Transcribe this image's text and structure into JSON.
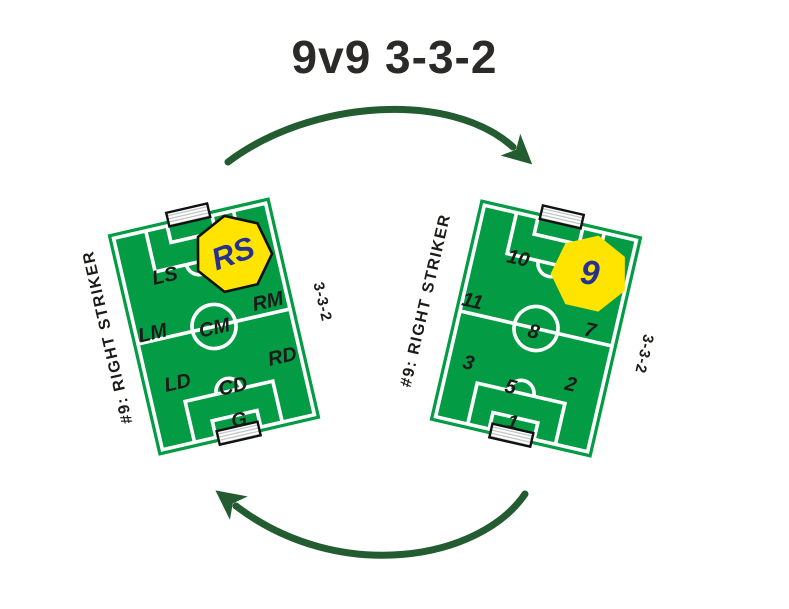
{
  "title": "9v9 3-3-2",
  "colors": {
    "field_green": "#049b45",
    "arrow_green": "#235c31",
    "badge_yellow": "#ffe400",
    "badge_number_blue": "#26328f",
    "text_black": "#1b1b19",
    "line_white": "#ffffff"
  },
  "left_field": {
    "side_label": "#9: RIGHT STRIKER",
    "formation_label": "3-3-2",
    "highlight_label": "RS",
    "positions": [
      {
        "label": "LS"
      },
      {
        "label": "RM"
      },
      {
        "label": "LM"
      },
      {
        "label": "CM"
      },
      {
        "label": "RD"
      },
      {
        "label": "LD"
      },
      {
        "label": "CD"
      },
      {
        "label": "G"
      }
    ]
  },
  "right_field": {
    "side_label": "#9: RIGHT STRIKER",
    "formation_label": "3-3-2",
    "highlight_label": "9",
    "positions": [
      {
        "label": "10"
      },
      {
        "label": "11"
      },
      {
        "label": "8"
      },
      {
        "label": "7"
      },
      {
        "label": "3"
      },
      {
        "label": "5"
      },
      {
        "label": "2"
      },
      {
        "label": "1"
      }
    ]
  },
  "icons": {
    "top_arrow": "curved-arrow-clockwise",
    "bottom_arrow": "curved-arrow-counterclockwise"
  }
}
